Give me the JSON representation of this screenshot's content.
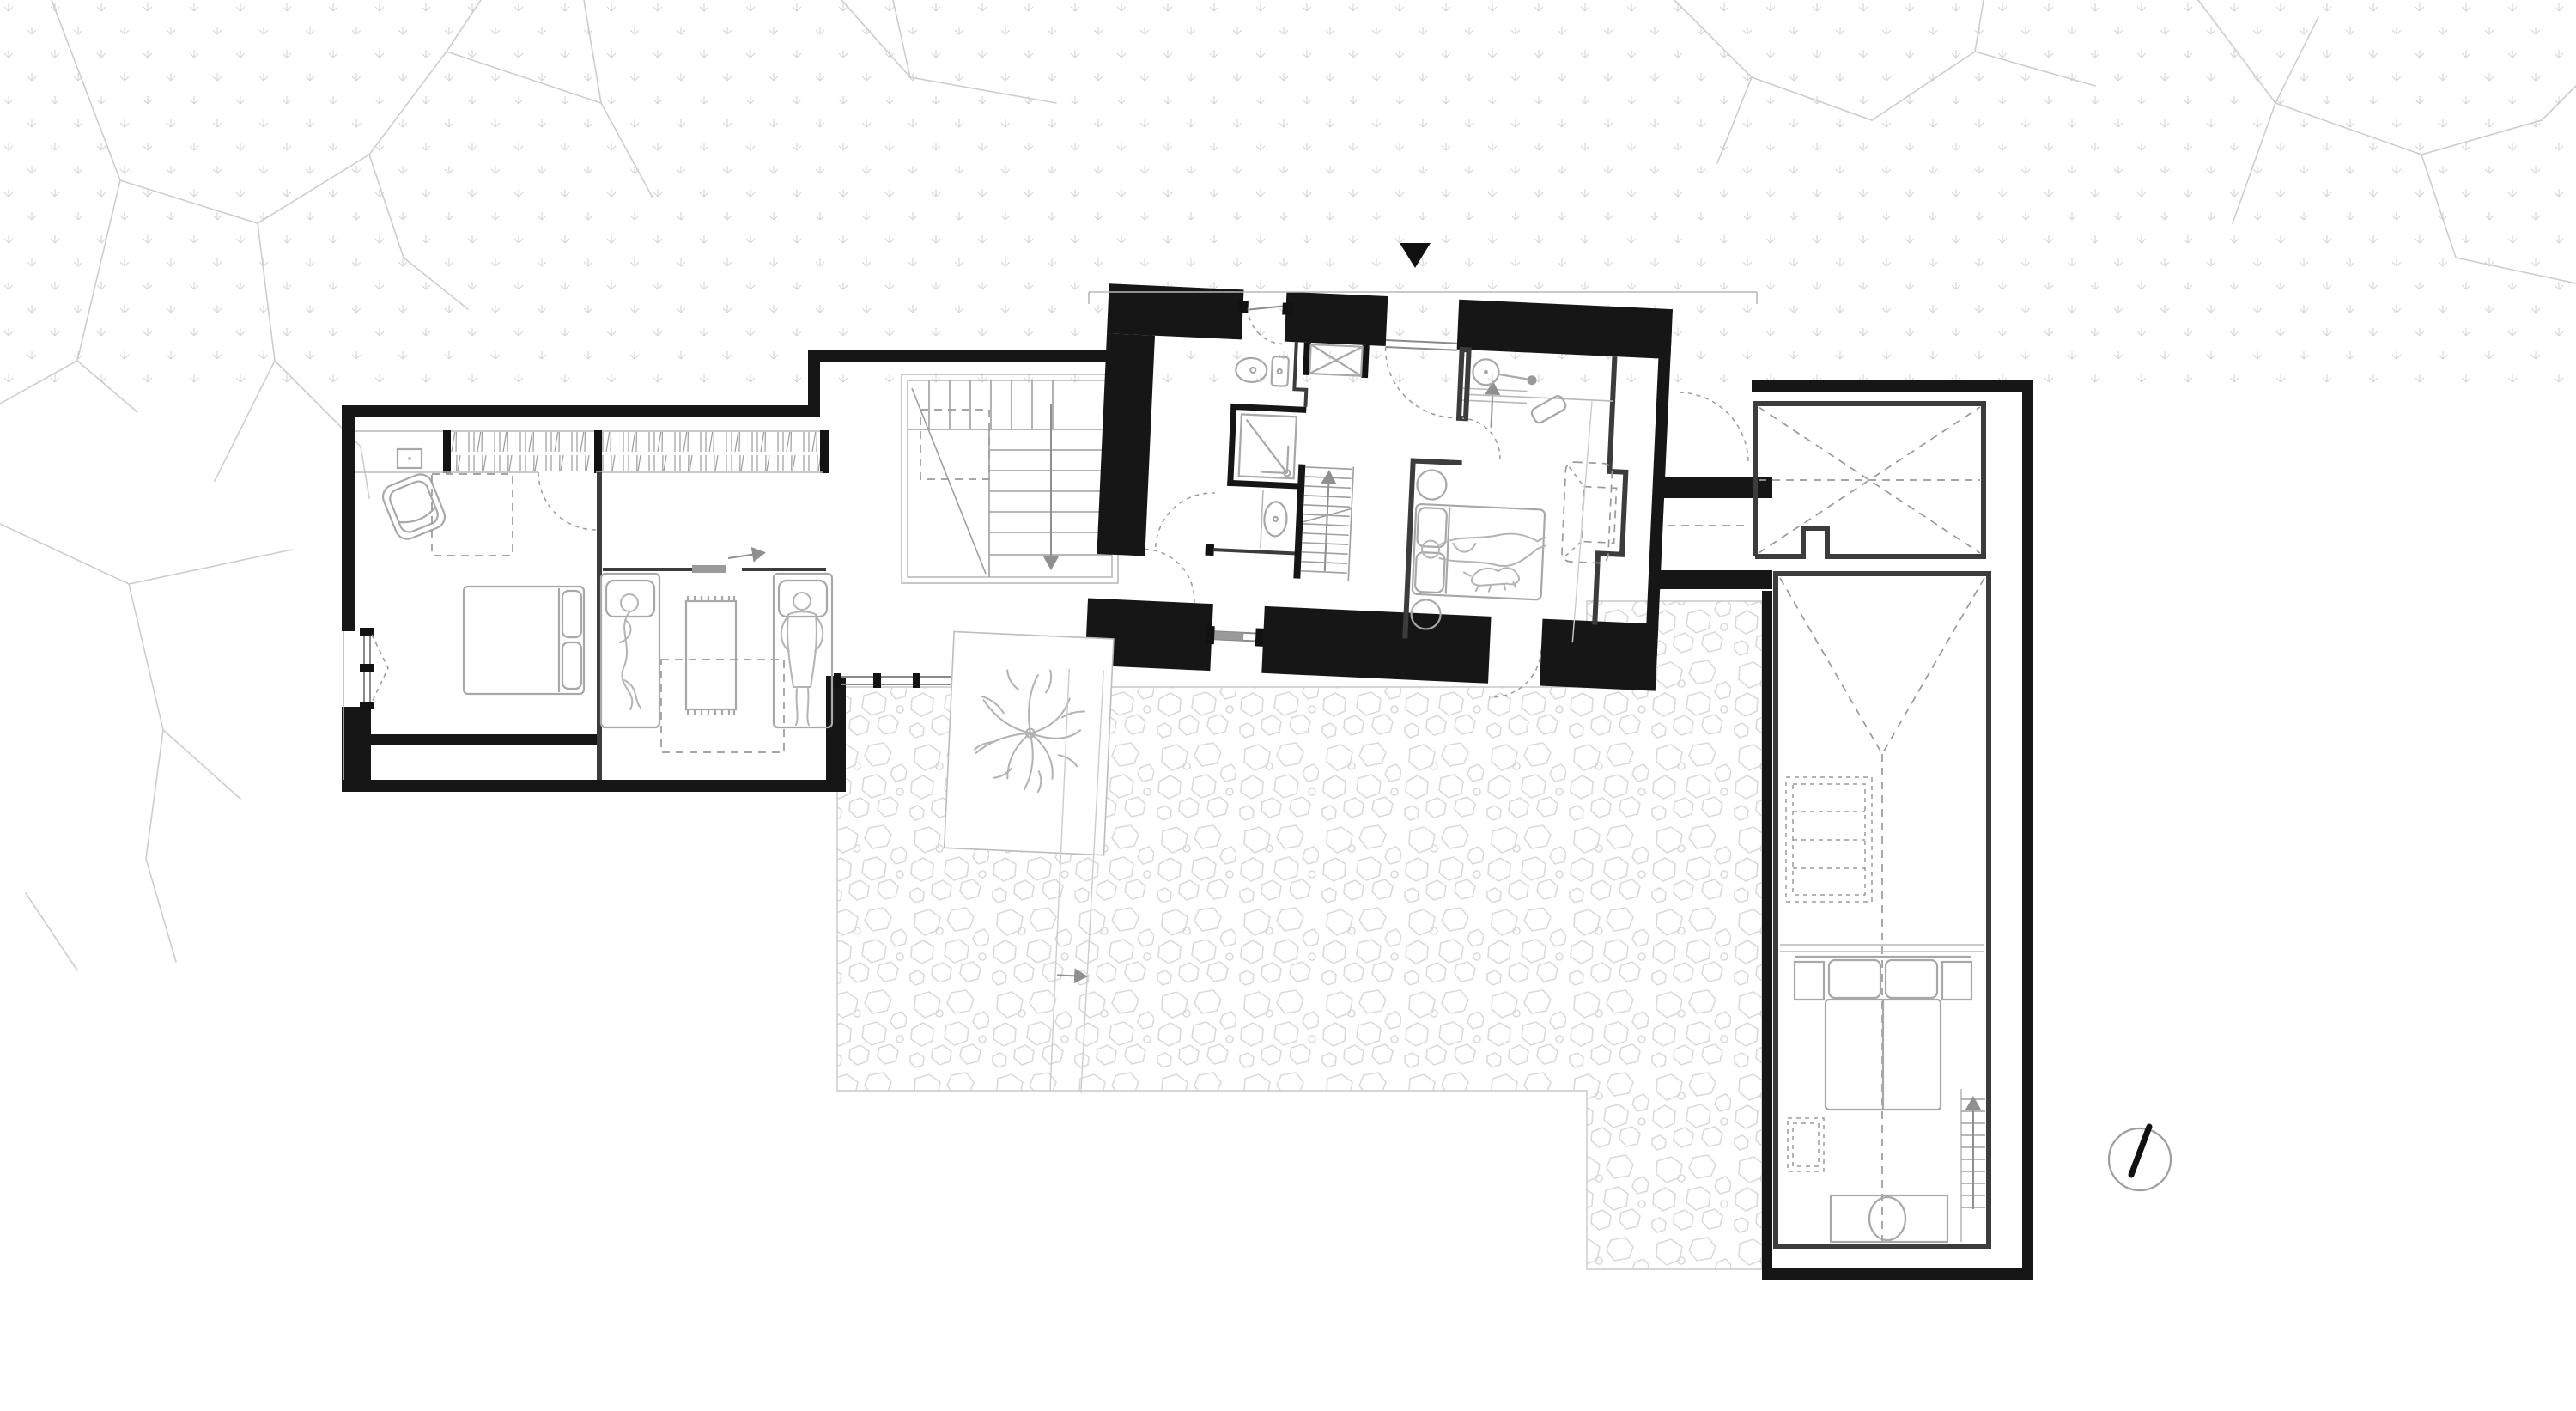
{
  "document": {
    "kind": "architectural floor plan drawing",
    "view": "top-down plan of an elongated house with three linked volumes, forecourt with tree pad and stone-paved patio",
    "visible_text": [],
    "orientation_symbols": [
      "entry-marker-triangle",
      "north-indicator-circle"
    ]
  },
  "colors": {
    "paper": "#ffffff",
    "wall": "#161616",
    "furniture": "#a8a8a8",
    "dashed": "#9a9a9a",
    "figure": "#b4b4b4",
    "glazing": "#8a8a8a",
    "branch": "#cdcdcd",
    "dots": "#d5d5d5",
    "stone": "#dadada",
    "hatch": "#9c9c9c"
  },
  "site": {
    "background_textures": [
      {
        "name": "dotted-ground-band",
        "area": "full-width strip along the top",
        "pattern": "tiny sprig / bird-foot marks in a staggered grid"
      },
      {
        "name": "tree-branches",
        "area": "top-left, mid-left, top-right corners",
        "pattern": "faint angular branch lines"
      },
      {
        "name": "stone-paving",
        "area": "L-shaped patio south of the house",
        "pattern": "irregular cobble outlines"
      }
    ],
    "features": [
      {
        "name": "entry-marker",
        "glyph": "▼",
        "position": "above main entry door"
      },
      {
        "name": "canopy-line",
        "type": "thin roof overhang line over entry front"
      },
      {
        "name": "concrete-pad-with-tree",
        "type": "white pad with plan-symbol tree"
      },
      {
        "name": "walkway-path",
        "type": "two slanted lines with direction arrow crossing the patio"
      },
      {
        "name": "north-indicator",
        "type": "circle with black needle",
        "position": "bottom right"
      }
    ]
  },
  "building": {
    "left_wing": {
      "rooms": [
        {
          "name": "master-bedroom-west",
          "furniture": [
            "wardrobe-hatch-band",
            "small-cabinet-square",
            "armchair",
            "double-bed-with-two-pillows",
            "dashed-skylight",
            "corner-window-with-dashed-bay"
          ]
        },
        {
          "name": "kids-bedroom",
          "furniture": [
            "single-bed-with-sleeping-figure",
            "single-bed-with-lying-figure",
            "fringed-rug",
            "dashed-skylight",
            "sliding-door"
          ]
        }
      ]
    },
    "hall_link": {
      "rooms": [
        {
          "name": "stair-hall",
          "furniture": [
            "l-shaped-staircase-with-down-arrow",
            "dashed-floor-opening",
            "full-height-glazing-band-with-mullions"
          ]
        }
      ]
    },
    "middle_volume": {
      "note": "old thick-walled volume, slightly rotated",
      "rooms": [
        {
          "name": "entry-vestibule",
          "furniture": [
            "entry-door-with-swing",
            "built-in-closet-x",
            "court-door-with-swing"
          ]
        },
        {
          "name": "bathroom",
          "furniture": [
            "toilet",
            "shower-with-drain",
            "washbasin-oval",
            "door-with-swing"
          ]
        },
        {
          "name": "stair-up",
          "furniture": [
            "straight-stair-with-up-arrow"
          ]
        },
        {
          "name": "master-bedroom-east",
          "furniture": [
            "double-bed-with-person-and-dog",
            "two-round-side-tables",
            "dashed-sofa-in-niche",
            "wall-heater-symbol",
            "angled-stool",
            "sliding-patio-door",
            "garden-door-with-swing"
          ]
        }
      ]
    },
    "right_wing": {
      "rooms": [
        {
          "name": "carport-roofed",
          "furniture": [
            "dashed-roof-x-diagonals",
            "dashed-centerline",
            "chimney-notch"
          ]
        },
        {
          "name": "breezeway-gap",
          "furniture": []
        },
        {
          "name": "guest-house",
          "furniture": [
            "dashed-roof-ridge-and-slopes",
            "dashed-shelving-unit",
            "double-bed-with-pillows",
            "two-nightstands",
            "dashed-rug",
            "straight-stair-with-up-arrow",
            "vanity-with-round-basin"
          ]
        }
      ]
    }
  }
}
